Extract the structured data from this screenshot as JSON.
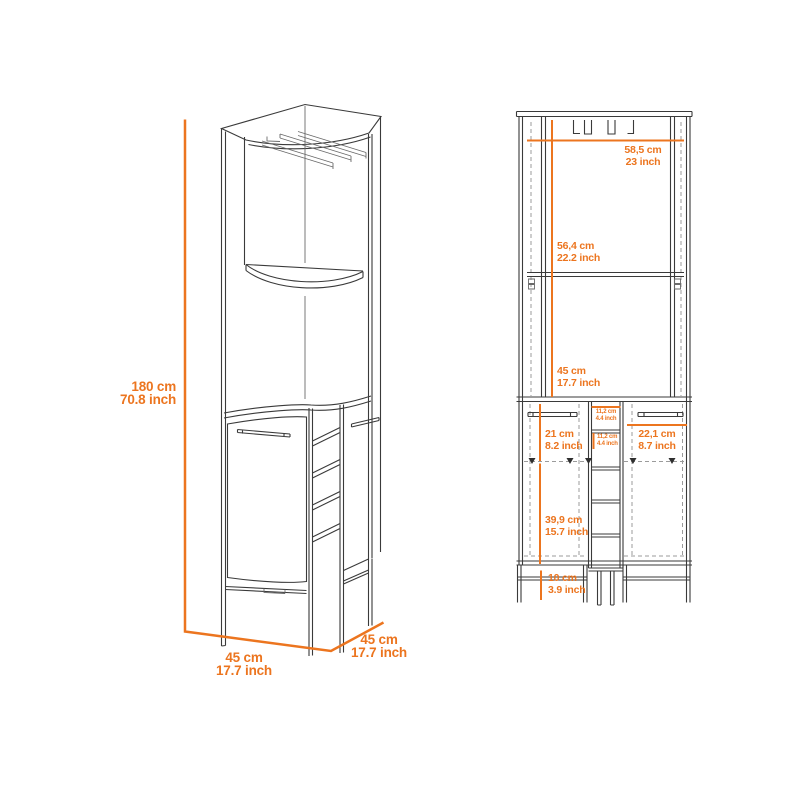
{
  "colors": {
    "accent": "#ec751f",
    "line": "#3a3a3a",
    "hidden_line": "#9b9b9b",
    "background": "#ffffff"
  },
  "views": {
    "perspective": {
      "labels": {
        "height": {
          "cm": "180 cm",
          "inch": "70.8 inch"
        },
        "depth": {
          "cm": "45 cm",
          "inch": "17.7 inch"
        },
        "width": {
          "cm": "45 cm",
          "inch": "17.7 inch"
        }
      }
    },
    "front": {
      "labels": {
        "top_width": {
          "cm": "58,5 cm",
          "inch": "23 inch"
        },
        "upper_section": {
          "cm": "56,4 cm",
          "inch": "22.2 inch"
        },
        "middle_section": {
          "cm": "45 cm",
          "inch": "17.7 inch"
        },
        "left_door": {
          "cm": "21 cm",
          "inch": "8.2 inch"
        },
        "cubby_width": {
          "cm": "11,2 cm",
          "inch": "4.4 inch"
        },
        "cubby_height": {
          "cm": "11,2 cm",
          "inch": "4.4 inch"
        },
        "right_door": {
          "cm": "22,1 cm",
          "inch": "8.7 inch"
        },
        "lower_section": {
          "cm": "39,9 cm",
          "inch": "15.7 inch"
        },
        "leg_height": {
          "cm": "10 cm",
          "inch": "3.9 inch"
        }
      }
    }
  }
}
